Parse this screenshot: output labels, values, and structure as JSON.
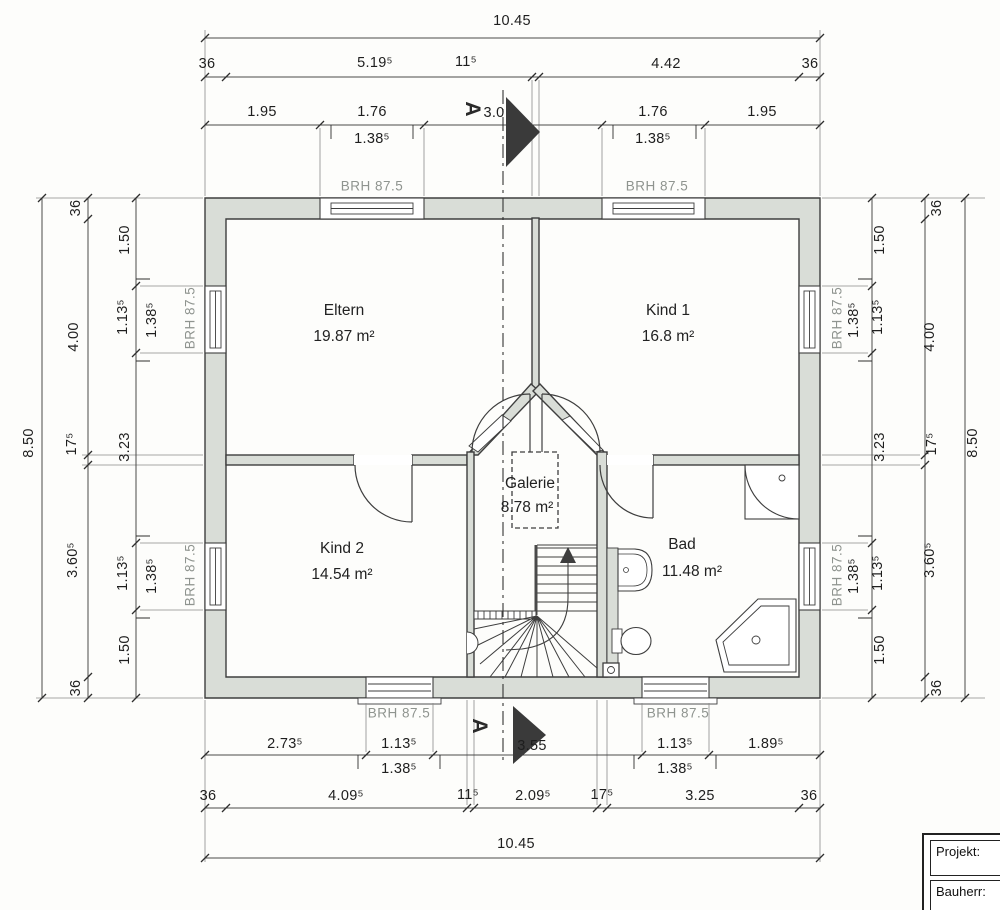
{
  "brh_label": "BRH 87.5",
  "section": {
    "label": "A"
  },
  "rooms": [
    {
      "name": "Eltern",
      "area": "19.87 m²"
    },
    {
      "name": "Kind 1",
      "area": "16.8 m²"
    },
    {
      "name": "Kind 2",
      "area": "14.54 m²"
    },
    {
      "name": "Galerie",
      "area": "8.78 m²"
    },
    {
      "name": "Bad",
      "area": "11.48 m²"
    }
  ],
  "dims": {
    "top_total": "10.45",
    "top_row2": [
      "36",
      "5.19⁵",
      "11⁵",
      "4.42",
      "36"
    ],
    "top_row3": [
      "1.95",
      "1.76",
      "3.0",
      "1.76",
      "1.95"
    ],
    "top_row3_sub": [
      "1.38⁵",
      "1.38⁵"
    ],
    "bottom_row1": [
      "2.73⁵",
      "1.13⁵",
      "3.55",
      "1.13⁵",
      "1.89⁵"
    ],
    "bottom_row1_sub": [
      "1.38⁵",
      "1.38⁵"
    ],
    "bottom_row2": [
      "36",
      "4.09⁵",
      "11⁵",
      "2.09⁵",
      "17⁵",
      "3.25",
      "36"
    ],
    "bottom_total": "10.45",
    "left_total": "8.50",
    "left_mid": [
      "36",
      "4.00",
      "17⁵",
      "3.60⁵",
      "36"
    ],
    "left_inner": [
      "1.50",
      "1.13⁵",
      "3.23",
      "1.13⁵",
      "1.50"
    ],
    "left_inner_sub": [
      "1.38⁵",
      "1.38⁵"
    ],
    "right_total": "8.50",
    "right_mid": [
      "36",
      "4.00",
      "17⁵",
      "3.60⁵",
      "36"
    ],
    "right_inner": [
      "1.50",
      "1.13⁵",
      "3.23",
      "1.13⁵",
      "1.50"
    ],
    "right_inner_sub": [
      "1.38⁵",
      "1.38⁵"
    ]
  },
  "titleblock": {
    "project_label": "Projekt:",
    "client_label": "Bauherr:"
  },
  "colors": {
    "wall_fill": "#d9ddd7",
    "line": "#3e3e3e",
    "dim_line": "#4a4a4a",
    "brh_text": "#8f948f"
  }
}
